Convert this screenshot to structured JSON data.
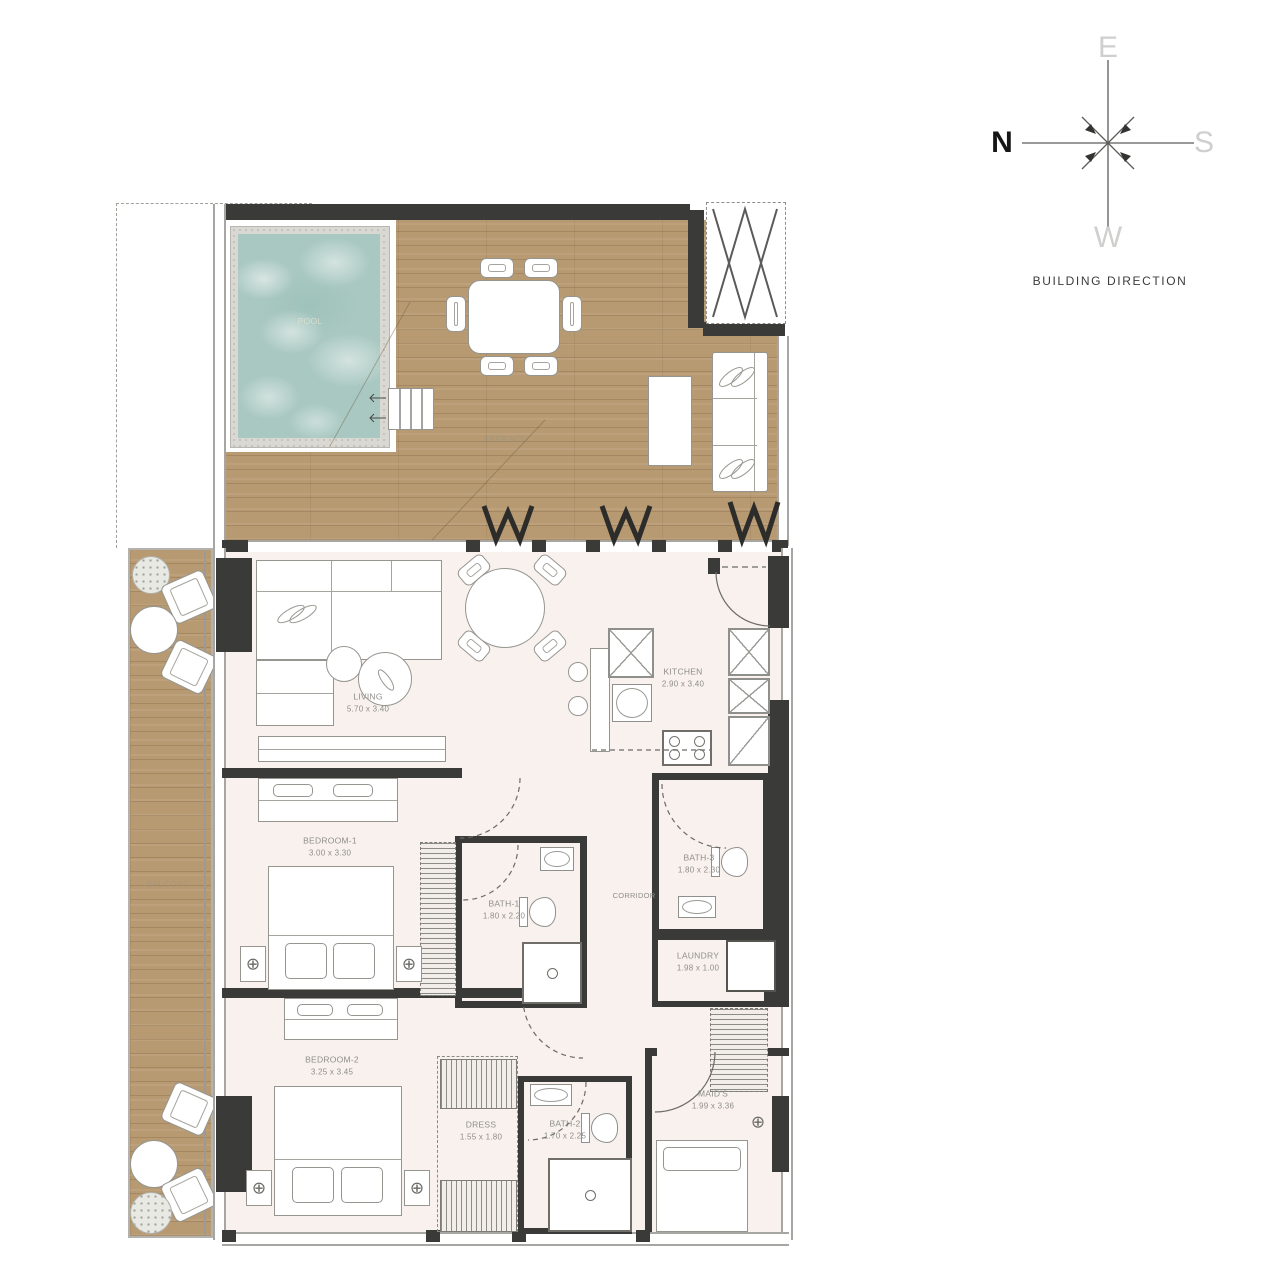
{
  "compass": {
    "north": "N",
    "south": "S",
    "east": "E",
    "west": "W",
    "caption": "BUILDING DIRECTION"
  },
  "icons": {
    "ceiling_light": "⊕"
  },
  "colors": {
    "wood": "#b79a72",
    "pool_water": "#a9c8c1",
    "floor": "#f8f1ee",
    "wall_dark": "#3a3a38",
    "wall_gray": "#a7a6a2",
    "furniture_line": "#96958f",
    "label_text": "#8f8e8a"
  },
  "rooms": {
    "terrace": {
      "label": "TERRACE"
    },
    "pool": {
      "label": "POOL"
    },
    "balcony": {
      "label": "BALCONY"
    },
    "living": {
      "label": "LIVING",
      "dims": "5.70 x 3.40"
    },
    "kitchen": {
      "label": "KITCHEN",
      "dims": "2.90 x 3.40"
    },
    "bedroom1": {
      "label": "BEDROOM-1",
      "dims": "3.00 x 3.30"
    },
    "bath1": {
      "label": "BATH-1",
      "dims": "1.80 x 2.20"
    },
    "corridor": {
      "label": "CORRIDOR"
    },
    "bath3": {
      "label": "BATH-3",
      "dims": "1.80 x 2.30"
    },
    "laundry": {
      "label": "LAUNDRY",
      "dims": "1.98 x 1.00"
    },
    "bedroom2": {
      "label": "BEDROOM-2",
      "dims": "3.25 x 3.45"
    },
    "dress": {
      "label": "DRESS",
      "dims": "1.55 x 1.80"
    },
    "bath2": {
      "label": "BATH-2",
      "dims": "1.70 x 2.25"
    },
    "maids": {
      "label": "MAID'S",
      "dims": "1.99 x 3.36"
    }
  }
}
